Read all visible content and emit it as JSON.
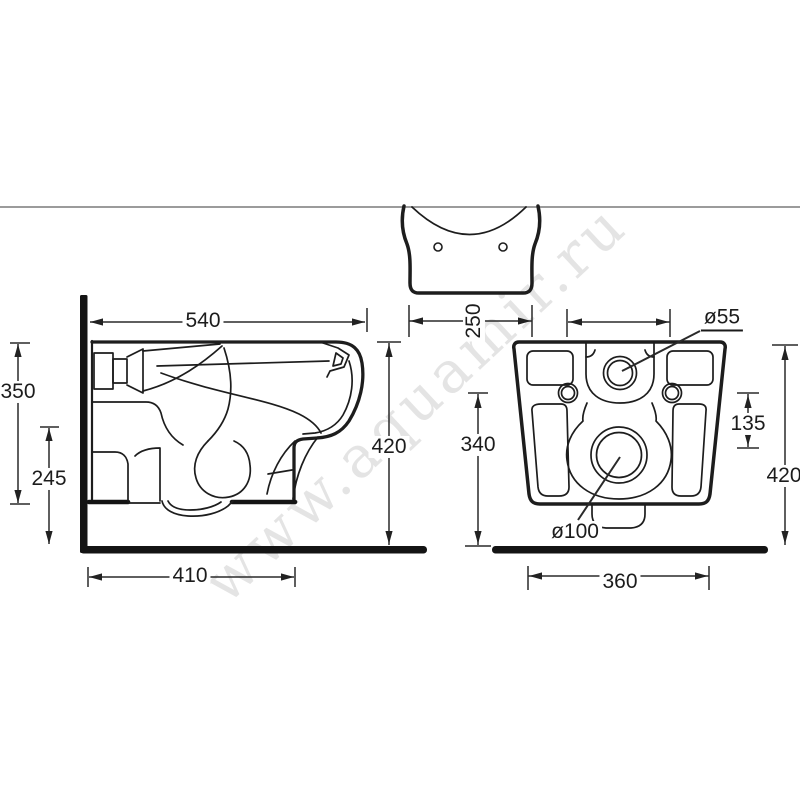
{
  "page": {
    "background": "#ffffff"
  },
  "divider": {
    "color": "#9b9b9b"
  },
  "watermark": {
    "text": "www.aquamir.ru",
    "color": "#e4e4e4"
  },
  "drawing": {
    "type": "technical-drawing",
    "subject": "wall-hung toilet installation dimensions",
    "line_color": "#1d1d1d",
    "heavy_bar_color": "#141414",
    "views": {
      "side": {
        "dimensions": {
          "top_width": "540",
          "overall_height": "350",
          "lower_height": "245",
          "wall_height": "420",
          "bottom_depth": "410"
        }
      },
      "plan": {
        "dimensions": {
          "outlet_box_width": "250"
        }
      },
      "back": {
        "dimensions": {
          "body_height": "340",
          "bolt_drop": "135",
          "overall_height": "420",
          "base_width": "360"
        },
        "callouts": {
          "inlet_diameter": "ø55",
          "outlet_diameter": "ø100"
        }
      }
    }
  }
}
